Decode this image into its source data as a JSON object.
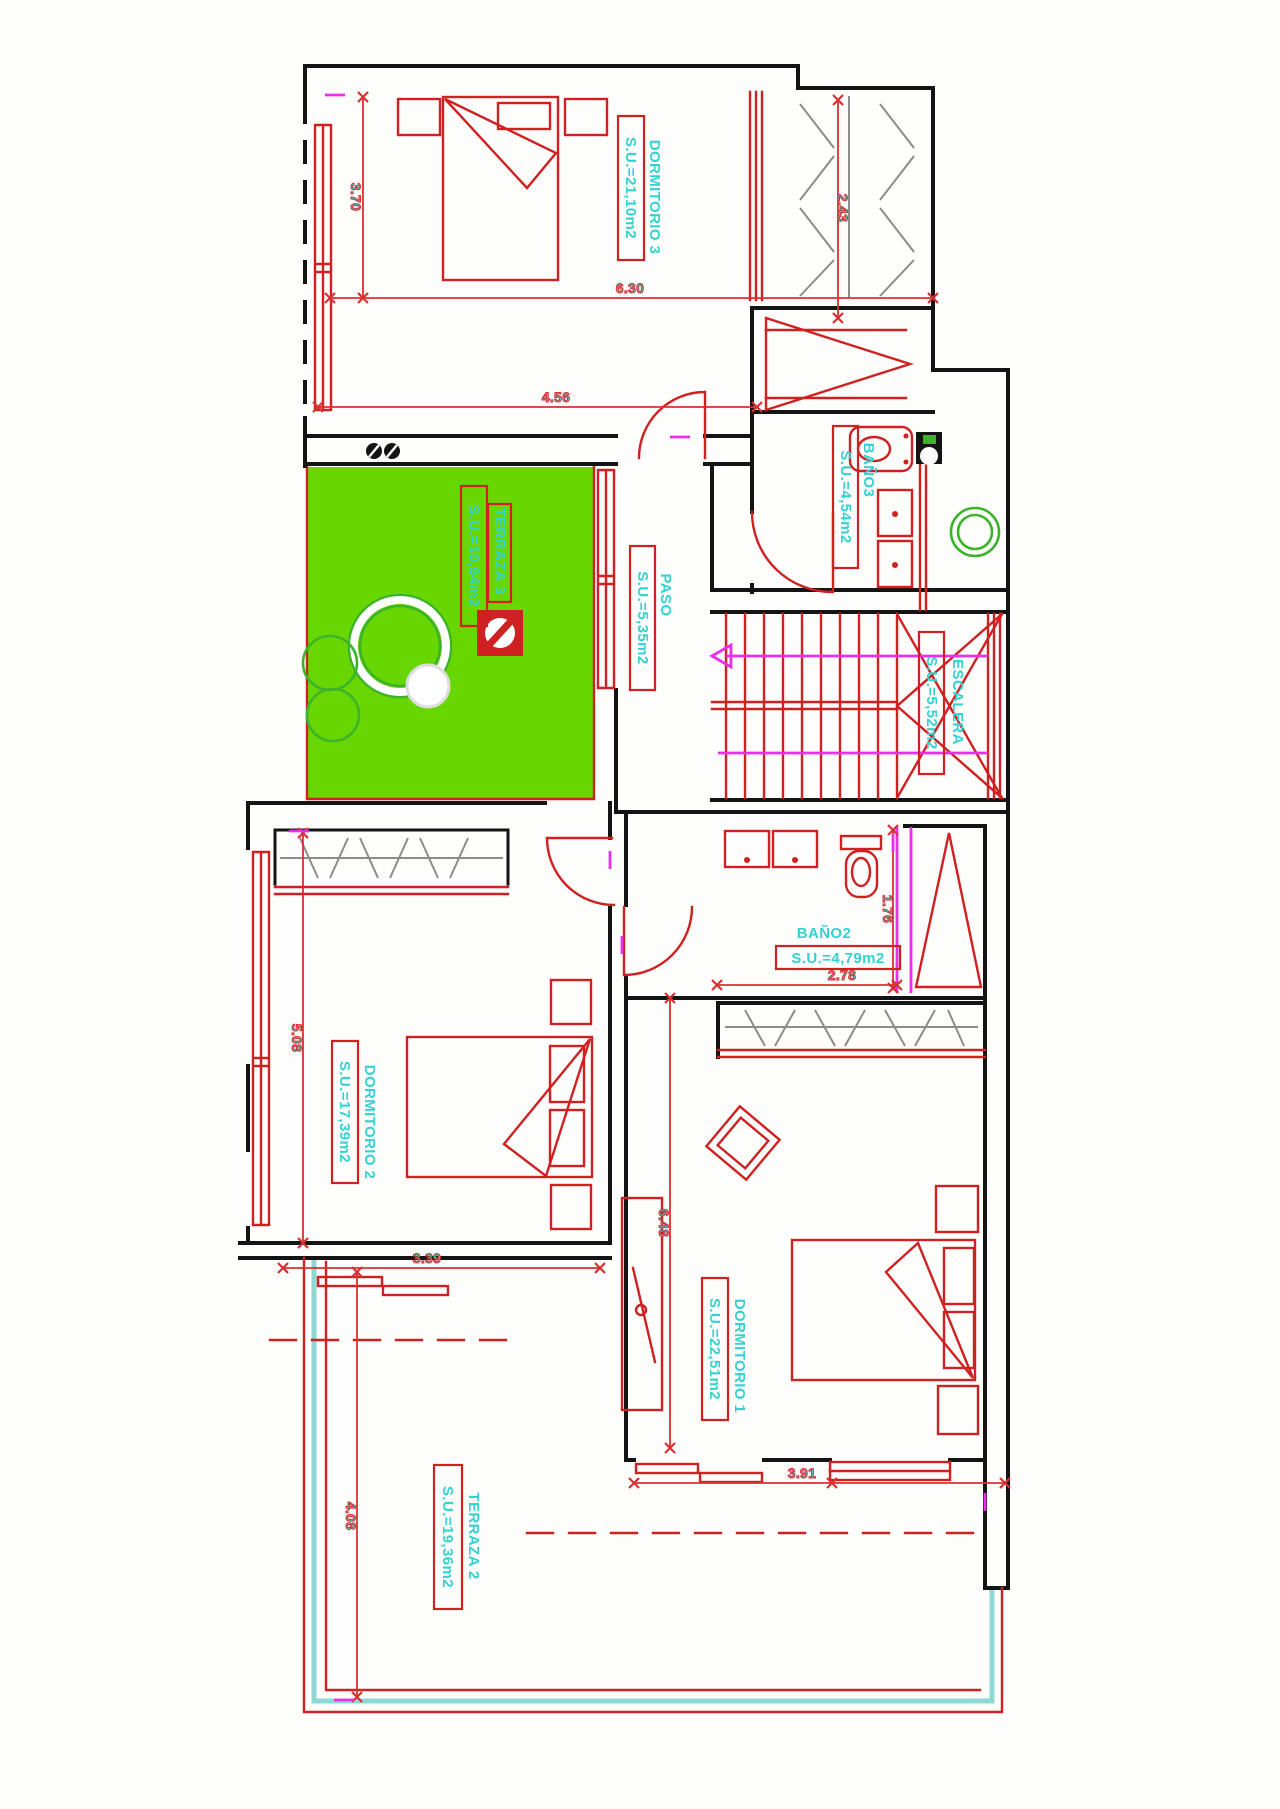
{
  "plan": {
    "rooms": {
      "dormitorio3": {
        "name": "DORMITORIO 3",
        "area": "S.U.=21,10m2"
      },
      "terraza3": {
        "name": "TERRAZA 3",
        "area": "S.U.=10,94m2"
      },
      "paso": {
        "name": "PASO",
        "area": "S.U.=5,35m2"
      },
      "bano3": {
        "name": "BAÑO3",
        "area": "S.U.=4,54m2"
      },
      "escalera": {
        "name": "ESCALERA",
        "area": "S.U.=5,52m2"
      },
      "bano2": {
        "name": "BAÑO2",
        "area": "S.U.=4,79m2"
      },
      "dormitorio2": {
        "name": "DORMITORIO 2",
        "area": "S.U.=17,39m2"
      },
      "dormitorio1": {
        "name": "DORMITORIO 1",
        "area": "S.U.=22,51m2"
      },
      "terraza2": {
        "name": "TERRAZA 2",
        "area": "S.U.=19,36m2"
      }
    },
    "dimensions": {
      "dorm3_left": "3.70",
      "dorm3_width": "6.30",
      "wardrobe3_height": "2.43",
      "dorm3_bottom": "4.56",
      "dorm2_height": "5.08",
      "dorm2_width": "3.39",
      "bano2_height": "1.76",
      "bano2_width": "2.78",
      "dorm1_height": "6.48",
      "dorm1_width": "3.91",
      "terraza2_height": "4.08"
    },
    "colors": {
      "walls": "#141414",
      "fixtures": "#cf2121",
      "labels": "#35d2d2",
      "terrace_fill": "#68d600",
      "dimension_marks": "#ea2fea",
      "terrace_border": "#8fd9d4"
    }
  }
}
